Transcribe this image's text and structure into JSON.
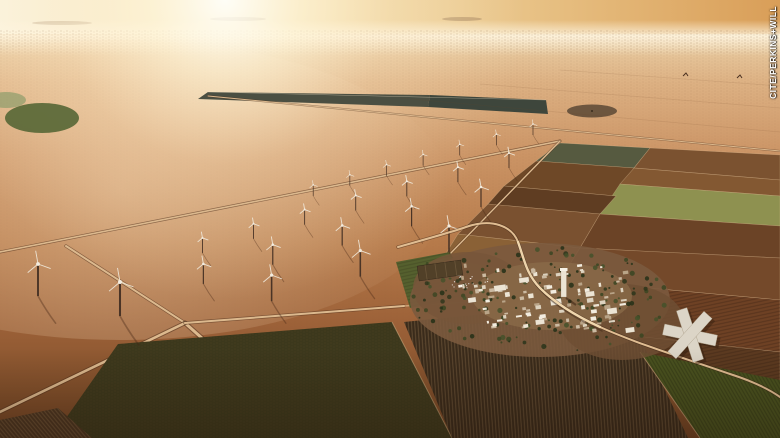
{
  "credit": {
    "text": "CITE/PERKINS+WILL"
  },
  "palette": {
    "credit_color": "#ffffff",
    "sky_left": "#faf3de",
    "sky_right": "#d99e58",
    "desert_light": "#ddb183",
    "desert_mid": "#b67a4a",
    "desert_dark": "#6f4223",
    "field_olive": "#3c381c",
    "field_green": "#49521f",
    "field_light_green": "#8e9150",
    "road_light": "#dcb98e",
    "building_white": "#ece4d4"
  }
}
